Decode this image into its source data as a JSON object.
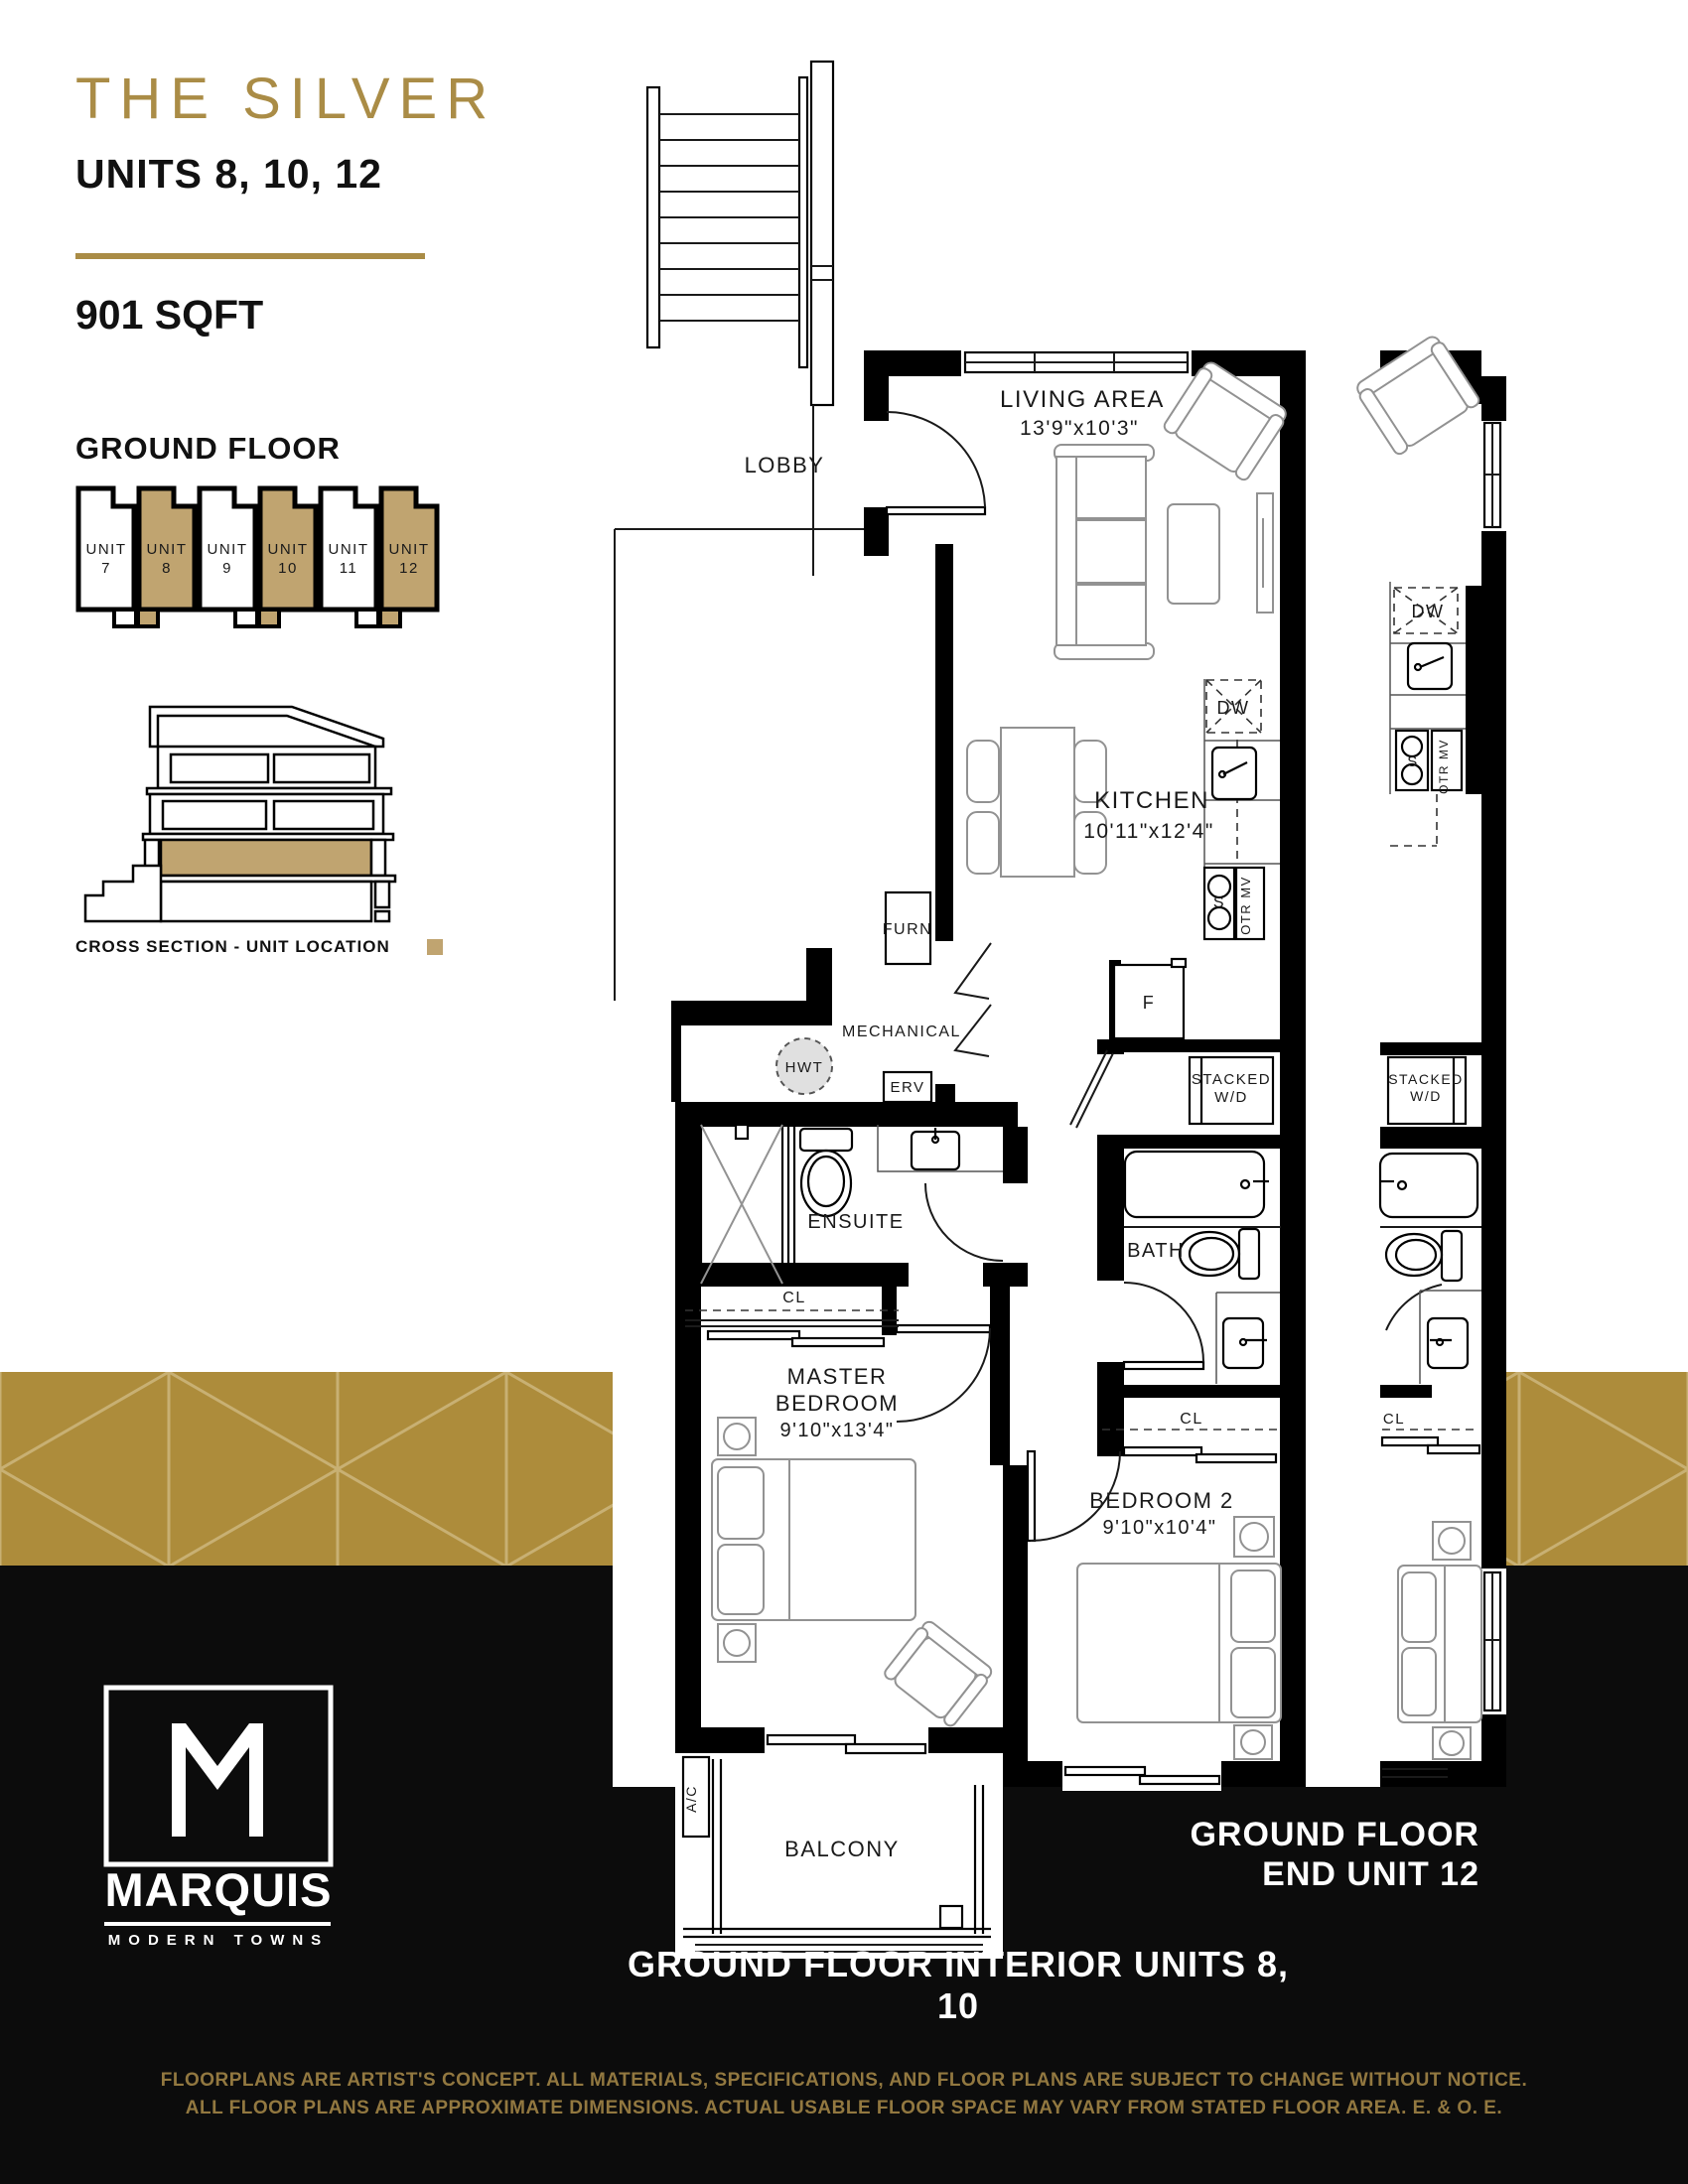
{
  "header": {
    "title": "THE SILVER",
    "subtitle": "UNITS 8, 10, 12",
    "sqft": "901 SQFT"
  },
  "ground_floor": {
    "heading": "GROUND FLOOR",
    "units": [
      {
        "label": "UNIT",
        "num": "7",
        "fill": "#FFFFFF"
      },
      {
        "label": "UNIT",
        "num": "8",
        "fill": "#C0A470"
      },
      {
        "label": "UNIT",
        "num": "9",
        "fill": "#FFFFFF"
      },
      {
        "label": "UNIT",
        "num": "10",
        "fill": "#C0A470"
      },
      {
        "label": "UNIT",
        "num": "11",
        "fill": "#FFFFFF"
      },
      {
        "label": "UNIT",
        "num": "12",
        "fill": "#C0A470"
      }
    ]
  },
  "cross_section": {
    "caption": "CROSS SECTION - UNIT LOCATION"
  },
  "plan": {
    "labels": {
      "lobby": "LOBBY",
      "living": "LIVING AREA",
      "living_dims": "13'9\"x10'3\"",
      "kitchen": "KITCHEN",
      "kitchen_dims": "10'11\"x12'4\"",
      "dw": "DW",
      "s": "S",
      "otr_mv": "OTR MV",
      "f": "F",
      "furn": "FURN",
      "mechanical": "MECHANICAL",
      "hwt": "HWT",
      "erv": "ERV",
      "ensuite": "ENSUITE",
      "cl": "CL",
      "master_1": "MASTER",
      "master_2": "BEDROOM",
      "master_dims": "9'10\"x13'4\"",
      "stacked_1": "STACKED",
      "stacked_2": "W/D",
      "bath": "BATH",
      "cl2": "CL",
      "bedroom2": "BEDROOM 2",
      "bedroom2_dims": "9'10\"x10'4\"",
      "ac": "A/C",
      "balcony": "BALCONY"
    },
    "strip": {
      "dw": "DW",
      "s": "S",
      "otr_mv": "OTR MV",
      "stacked_1": "STACKED",
      "stacked_2": "W/D",
      "cl": "CL"
    }
  },
  "captions": {
    "end_line1": "GROUND FLOOR",
    "end_line2": "END UNIT 12",
    "interior": "GROUND FLOOR INTERIOR UNITS 8, 10"
  },
  "brand": {
    "monogram": "M",
    "name": "MARQUIS",
    "tagline": "MODERN TOWNS"
  },
  "footer": {
    "line1": "FLOORPLANS ARE ARTIST'S CONCEPT. ALL MATERIALS, SPECIFICATIONS, AND FLOOR PLANS ARE SUBJECT TO CHANGE WITHOUT NOTICE.",
    "line2": "ALL FLOOR PLANS ARE APPROXIMATE DIMENSIONS. ACTUAL USABLE FLOOR SPACE MAY VARY FROM STATED FLOOR AREA. E. & O. E."
  },
  "colors": {
    "gold_title": "#AA8C46",
    "gold_band": "#AD8C3B",
    "pattern_line": "#C8B073",
    "unit_fill": "#C0A470",
    "footer_text": "#927840"
  }
}
